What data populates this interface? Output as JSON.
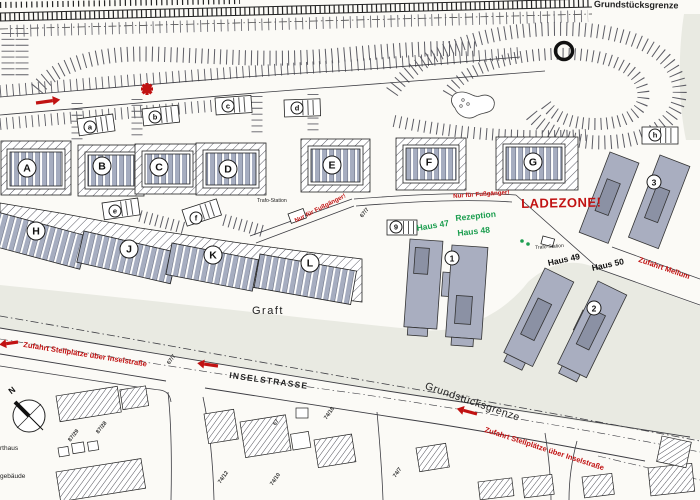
{
  "colors": {
    "red": "#c11212",
    "green": "#1d9e50",
    "building_gray": "#a9aec0",
    "water_gray": "#e9eae2",
    "hatch": "#55555f",
    "paper": "#fbfaf6"
  },
  "labels": [
    {
      "name": "grundstuecksgrenze-top",
      "text": "Grundstücksgrenze",
      "x": 594,
      "y": 0,
      "rot": 1,
      "size": 9,
      "weight": 700,
      "color": "#222"
    },
    {
      "name": "grundstuecksgrenze-bottom",
      "text": "Grundstücksgrenze",
      "x": 427,
      "y": 381,
      "rot": 19,
      "size": 10.5,
      "weight": 400,
      "color": "#222",
      "ls": 0.5
    },
    {
      "name": "graft-label",
      "text": "Graft",
      "x": 252,
      "y": 306,
      "rot": 0,
      "size": 11,
      "weight": 400,
      "color": "#222",
      "ls": 1.5
    },
    {
      "name": "inselstrasse-label",
      "text": "INSELSTRASSE",
      "x": 230,
      "y": 371,
      "rot": 8,
      "size": 8.5,
      "weight": 700,
      "color": "#222",
      "ls": 1.2
    },
    {
      "name": "ladezone-label",
      "text": "LADEZONE!",
      "x": 521,
      "y": 197,
      "rot": -1,
      "size": 13,
      "weight": 800,
      "color": "#c11212",
      "ls": 0.5
    },
    {
      "name": "rezeption-label",
      "text": "Rezeption",
      "x": 455,
      "y": 214,
      "rot": -6,
      "size": 8.5,
      "weight": 700,
      "color": "#1d9e50"
    },
    {
      "name": "haus-48-label",
      "text": "Haus 48",
      "x": 457,
      "y": 229,
      "rot": -6,
      "size": 8.5,
      "weight": 700,
      "color": "#1d9e50"
    },
    {
      "name": "haus-47-label",
      "text": "Haus 47",
      "x": 416,
      "y": 224,
      "rot": -9,
      "size": 8.5,
      "weight": 700,
      "color": "#1d9e50"
    },
    {
      "name": "haus-49-label",
      "text": "Haus 49",
      "x": 547,
      "y": 259,
      "rot": -12,
      "size": 8.5,
      "weight": 700,
      "color": "#111"
    },
    {
      "name": "haus-50-label",
      "text": "Haus 50",
      "x": 591,
      "y": 264,
      "rot": -12,
      "size": 8.5,
      "weight": 700,
      "color": "#111"
    },
    {
      "name": "nur-fuer-fussgaenger-1",
      "text": "Nur für Fußgänger!",
      "x": 294,
      "y": 219,
      "rot": -27,
      "size": 6.2,
      "weight": 700,
      "color": "#c11212"
    },
    {
      "name": "nur-fuer-fussgaenger-2",
      "text": "Nur für Fußgänger!",
      "x": 453,
      "y": 194,
      "rot": -4,
      "size": 6.2,
      "weight": 700,
      "color": "#c11212"
    },
    {
      "name": "zufahrt-stellplaetze-left",
      "text": "Zufahrt Stellplätze über Inselstraße",
      "x": 24,
      "y": 341,
      "rot": 9,
      "size": 7.5,
      "weight": 700,
      "color": "#c11212"
    },
    {
      "name": "zufahrt-stellplaetze-right",
      "text": "Zufahrt Stellplätze über Inselstraße",
      "x": 486,
      "y": 426,
      "rot": 18,
      "size": 7.5,
      "weight": 700,
      "color": "#c11212"
    },
    {
      "name": "zufahrt-mellum",
      "text": "Zufahrt Mellum",
      "x": 640,
      "y": 256,
      "rot": 19,
      "size": 7.5,
      "weight": 700,
      "color": "#c11212"
    },
    {
      "name": "trafo-station-1",
      "text": "Trafo-Station",
      "x": 257,
      "y": 199,
      "rot": 0,
      "size": 5.2,
      "weight": 400,
      "color": "#222"
    },
    {
      "name": "trafo-station-2",
      "text": "Trafo-Station",
      "x": 535,
      "y": 246,
      "rot": -4,
      "size": 5,
      "weight": 400,
      "color": "#222"
    },
    {
      "name": "compass-n-label",
      "text": "N",
      "x": 7,
      "y": 389,
      "rot": -38,
      "size": 8.5,
      "weight": 700,
      "color": "#111"
    },
    {
      "name": "edge-label-rthaus",
      "text": "rthaus",
      "x": 0,
      "y": 446,
      "rot": 0,
      "size": 6.5,
      "weight": 400,
      "color": "#222"
    },
    {
      "name": "edge-label-gebaeude",
      "text": "gebäude",
      "x": 0,
      "y": 474,
      "rot": 0,
      "size": 6.5,
      "weight": 400,
      "color": "#222"
    }
  ],
  "lot_labels": [
    {
      "text": "67/7",
      "x": 360,
      "y": 216,
      "rot": -52
    },
    {
      "text": "67/7",
      "x": 167,
      "y": 363,
      "rot": -55
    },
    {
      "text": "87/29",
      "x": 68,
      "y": 440,
      "rot": -52
    },
    {
      "text": "87/28",
      "x": 96,
      "y": 432,
      "rot": -52
    },
    {
      "text": "74/18",
      "x": 324,
      "y": 418,
      "rot": -55
    },
    {
      "text": "74/12",
      "x": 218,
      "y": 482,
      "rot": -55
    },
    {
      "text": "74/10",
      "x": 270,
      "y": 484,
      "rot": -55
    },
    {
      "text": "67",
      "x": 273,
      "y": 424,
      "rot": -55
    },
    {
      "text": "74/7",
      "x": 393,
      "y": 476,
      "rot": -55
    }
  ],
  "circles": [
    {
      "t": "A",
      "x": 27,
      "y": 168,
      "k": "big"
    },
    {
      "t": "B",
      "x": 102,
      "y": 166,
      "k": "big"
    },
    {
      "t": "C",
      "x": 159,
      "y": 167,
      "k": "big"
    },
    {
      "t": "D",
      "x": 228,
      "y": 169,
      "k": "big"
    },
    {
      "t": "E",
      "x": 332,
      "y": 165,
      "k": "big"
    },
    {
      "t": "F",
      "x": 429,
      "y": 162,
      "k": "big"
    },
    {
      "t": "G",
      "x": 533,
      "y": 162,
      "k": "big"
    },
    {
      "t": "H",
      "x": 36,
      "y": 231,
      "k": "big"
    },
    {
      "t": "J",
      "x": 129,
      "y": 249,
      "k": "big"
    },
    {
      "t": "K",
      "x": 213,
      "y": 255,
      "k": "big"
    },
    {
      "t": "L",
      "x": 310,
      "y": 263,
      "k": "big"
    },
    {
      "t": "1",
      "x": 452,
      "y": 258,
      "k": "mid"
    },
    {
      "t": "2",
      "x": 594,
      "y": 308,
      "k": "mid"
    },
    {
      "t": "3",
      "x": 654,
      "y": 182,
      "k": "mid"
    },
    {
      "t": "a",
      "x": 90,
      "y": 127,
      "k": "small"
    },
    {
      "t": "b",
      "x": 155,
      "y": 117,
      "k": "small"
    },
    {
      "t": "c",
      "x": 228,
      "y": 106,
      "k": "small"
    },
    {
      "t": "d",
      "x": 297,
      "y": 108,
      "k": "small"
    },
    {
      "t": "e",
      "x": 115,
      "y": 211,
      "k": "small"
    },
    {
      "t": "f",
      "x": 196,
      "y": 218,
      "k": "small"
    },
    {
      "t": "h",
      "x": 655,
      "y": 135,
      "k": "small"
    },
    {
      "t": "9",
      "x": 396,
      "y": 227,
      "k": "small"
    }
  ]
}
